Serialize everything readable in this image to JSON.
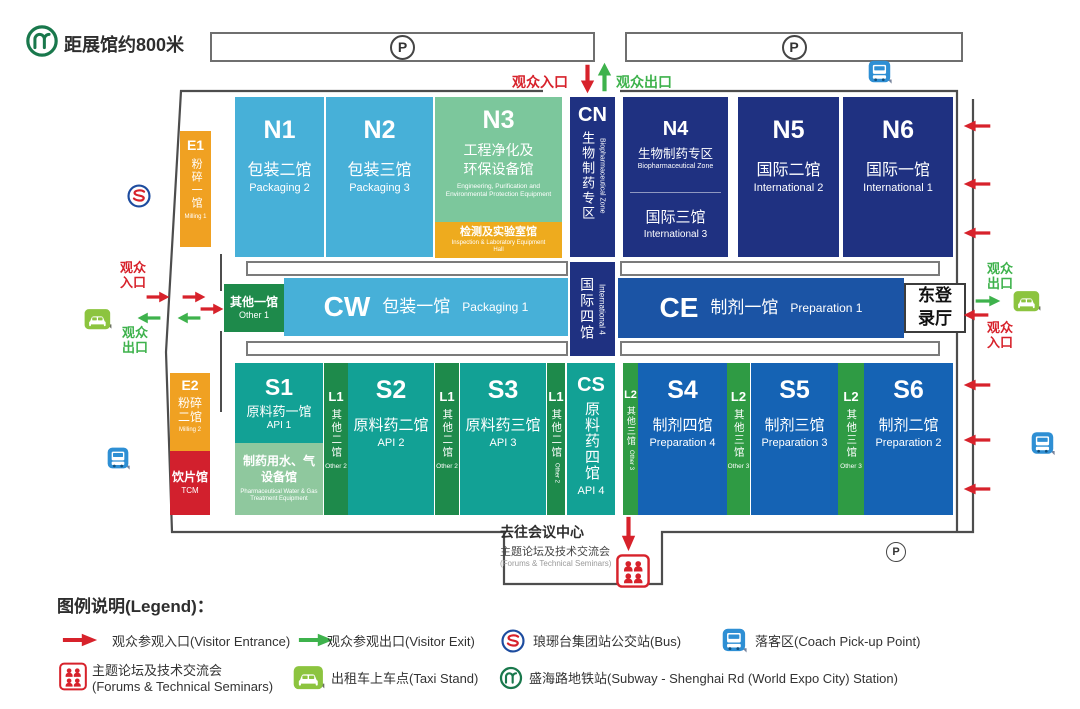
{
  "header": {
    "metro_distance": "距展馆约800米",
    "parking": "P",
    "entrance": "观众入口",
    "exit": "观众出口"
  },
  "halls": {
    "e1": {
      "code": "E1",
      "cn": "粉碎一馆",
      "en": "Milling 1"
    },
    "e2": {
      "code": "E2",
      "cn": "粉碎二馆",
      "en": "Milling 2"
    },
    "tcm": {
      "cn": "饮片馆",
      "en": "TCM"
    },
    "n1": {
      "code": "N1",
      "cn": "包装二馆",
      "en": "Packaging 2"
    },
    "n2": {
      "code": "N2",
      "cn": "包装三馆",
      "en": "Packaging 3"
    },
    "n3": {
      "code": "N3",
      "cn": "工程净化及环保设备馆",
      "en": "Engineering, Purification and Environmental Protection Equipment"
    },
    "n3_sub": {
      "cn": "检测及实验室馆",
      "en": "Inspection & Laboratory Equipment Hall"
    },
    "cn": {
      "code": "CN",
      "cn": "生物制药专区",
      "en": "Biopharmaceutical Zone"
    },
    "intl4": {
      "cn": "国际四馆",
      "en": "International 4"
    },
    "n4": {
      "code": "N4",
      "cn": "生物制药专区",
      "en": "Biopharmaceutical Zone"
    },
    "n4b": {
      "cn": "国际三馆",
      "en": "International 3"
    },
    "n5": {
      "code": "N5",
      "cn": "国际二馆",
      "en": "International 2"
    },
    "n6": {
      "code": "N6",
      "cn": "国际一馆",
      "en": "International 1"
    },
    "other1": {
      "cn": "其他一馆",
      "en": "Other 1"
    },
    "cw": {
      "code": "CW",
      "cn": "包装一馆",
      "en": "Packaging 1"
    },
    "ce": {
      "code": "CE",
      "cn": "制剂一馆",
      "en": "Preparation 1"
    },
    "east_hall": {
      "cn": "东登录厅"
    },
    "s1": {
      "code": "S1",
      "cn": "原料药一馆",
      "en": "API 1"
    },
    "s1_sub": {
      "cn": "制药用水、气设备馆",
      "en": "Pharmaceutical Water & Gas Treatment Equipment"
    },
    "l1": {
      "code": "L1",
      "cn": "其他二馆",
      "en": "Other 2"
    },
    "s2": {
      "code": "S2",
      "cn": "原料药二馆",
      "en": "API 2"
    },
    "s3": {
      "code": "S3",
      "cn": "原料药三馆",
      "en": "API 3"
    },
    "cs": {
      "code": "CS",
      "cn": "原料药四馆",
      "en": "API 4"
    },
    "l2": {
      "code": "L2",
      "cn": "其他三馆",
      "en": "Other 3"
    },
    "s4": {
      "code": "S4",
      "cn": "制剂四馆",
      "en": "Preparation 4"
    },
    "s5": {
      "code": "S5",
      "cn": "制剂三馆",
      "en": "Preparation 3"
    },
    "s6": {
      "code": "S6",
      "cn": "制剂二馆",
      "en": "Preparation 2"
    }
  },
  "conference": {
    "to": "去往会议中心",
    "cn": "主题论坛及技术交流会",
    "en": "(Forums & Technical Seminars)"
  },
  "legend": {
    "title": "图例说明(Legend)：",
    "entrance": "观众参观入口(Visitor Entrance)",
    "exit": "观众参观出口(Visitor Exit)",
    "bus": "琅琊台集团站公交站(Bus)",
    "coach": "落客区(Coach Pick-up Point)",
    "forums_cn": "主题论坛及技术交流会",
    "forums_en": "(Forums & Technical Seminars)",
    "taxi": "出租车上车点(Taxi Stand)",
    "subway": "盛海路地铁站(Subway - Shenghai Rd (World Expo City) Station)"
  },
  "colors": {
    "accent_red": "#d7222b",
    "accent_green": "#3eb24c",
    "navy": "#1f3181",
    "royal_blue": "#1b54a5",
    "blue": "#1563b4",
    "light_blue": "#47b0d8",
    "teal": "#12a195",
    "green_dark": "#1e8a4b",
    "green_mid": "#2f9b44",
    "green_light": "#8fc89e",
    "green_n3": "#7cc79c",
    "orange": "#f0a122",
    "orange_deep": "#eeab1e",
    "red_hall": "#d2202d",
    "taxi_green": "#8cc43f",
    "coach_blue": "#2e8fd4",
    "metro_green": "#19784c",
    "bus_ring_blue": "#1d4c9f",
    "wall_gray": "#4d4d4d"
  }
}
